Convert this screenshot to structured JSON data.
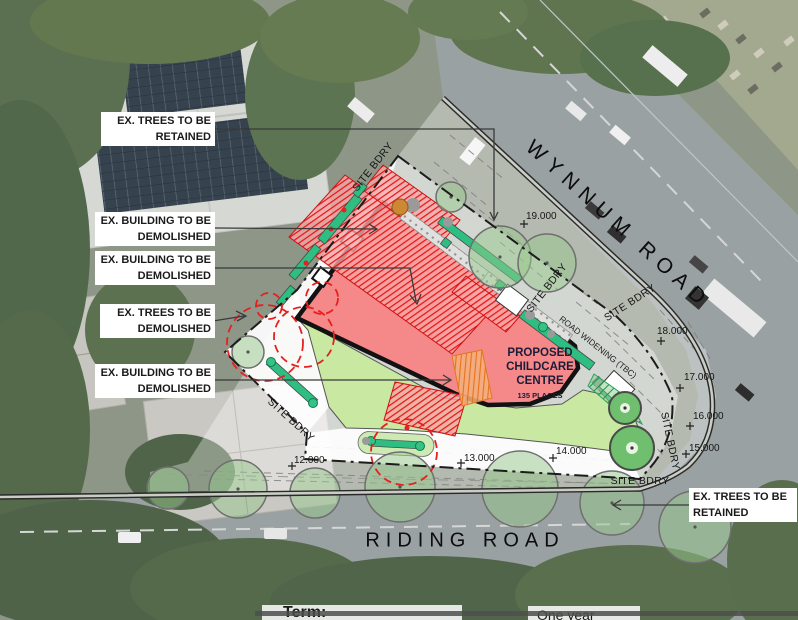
{
  "plan": {
    "roads": {
      "wynnum": "WYNNUM ROAD",
      "riding": "RIDING ROAD"
    },
    "callouts": {
      "trees_retained_top": {
        "line1": "EX. TREES TO BE",
        "line2": "RETAINED"
      },
      "building_demolished_1": {
        "line1": "EX. BUILDING TO BE",
        "line2": "DEMOLISHED"
      },
      "building_demolished_2": {
        "line1": "EX. BUILDING TO BE",
        "line2": "DEMOLISHED"
      },
      "trees_demolished": {
        "line1": "EX. TREES TO BE",
        "line2": "DEMOLISHED"
      },
      "building_demolished_3": {
        "line1": "EX. BUILDING TO BE",
        "line2": "DEMOLISHED"
      },
      "trees_retained_bottom": {
        "line1": "EX. TREES TO BE",
        "line2": "RETAINED"
      }
    },
    "proposed_centre": {
      "line1": "PROPOSED",
      "line2": "CHILDCARE",
      "line3": "CENTRE",
      "line4": "135 PLACES"
    },
    "road_widening": "ROAD WIDENING (TBC)",
    "site_bdry_label": "SITE BDRY",
    "contours": {
      "c19": "19.000",
      "c18": "18.000",
      "c17": "17.000",
      "c16": "16.000",
      "c15": "15.000",
      "c14": "14.000",
      "c13": "13.000",
      "c12": "12.000"
    },
    "colors": {
      "proposed_fill": "#f58888",
      "demolish_hatch": "#e31313",
      "lawn": "#c9e8a2",
      "hedge": "#2fbe82",
      "tree_fill": "#96c88c",
      "demolish_tree_dash": "#e62020",
      "outline": "#121212"
    }
  },
  "footer": {
    "term_label": "Term:",
    "term_value": "One year"
  }
}
